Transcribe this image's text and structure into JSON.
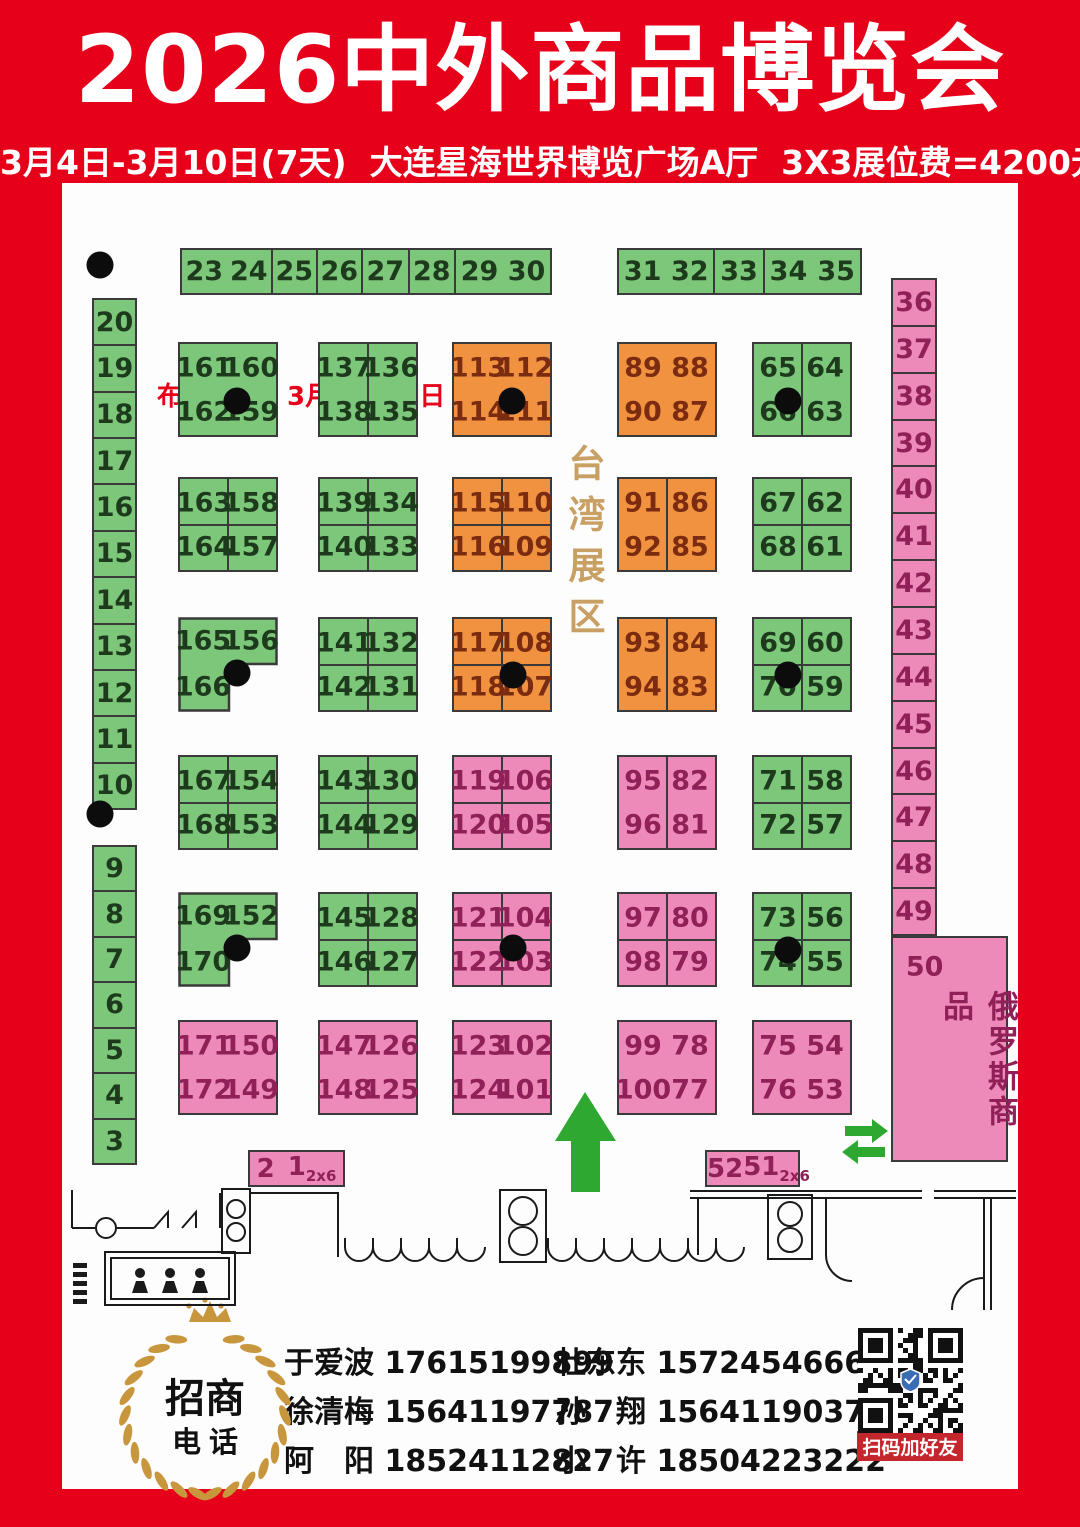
{
  "header": {
    "title": "2026中外商品博览会",
    "subtitle": "3月4日-3月10日(7天)  大连星海世界博览广场A厅  3X3展位费=4200元",
    "note": "布展日期：3月2日、3日"
  },
  "palette": {
    "red": "#e60019",
    "green": "#7dc77b",
    "orange": "#f0923f",
    "pink": "#ee8ab9",
    "border": "#3a3a3a",
    "green_text": "#1d3a1d",
    "orange_text": "#7a2b10",
    "pink_text": "#8f2058",
    "taiwan_text": "#c9a064",
    "arrow_green": "#2fa832",
    "dot": "#0c0c0c",
    "qr_label_bg": "#c4262d",
    "gold": "#c8963c"
  },
  "zones": {
    "taiwan_label": "台湾展区",
    "russia_label": "俄罗斯商品",
    "russia_booth": "50"
  },
  "strips": [
    {
      "x": 180,
      "y": 248,
      "w": 372,
      "h": 47,
      "color": "green",
      "cells": [
        {
          "w": 92,
          "labels": [
            "23",
            "24"
          ]
        },
        {
          "w": 45,
          "labels": [
            "25"
          ]
        },
        {
          "w": 46,
          "labels": [
            "26"
          ]
        },
        {
          "w": 47,
          "labels": [
            "27"
          ]
        },
        {
          "w": 47,
          "labels": [
            "28"
          ]
        },
        {
          "w": 95,
          "labels": [
            "29",
            "30"
          ]
        }
      ]
    },
    {
      "x": 617,
      "y": 248,
      "w": 245,
      "h": 47,
      "color": "green",
      "cells": [
        {
          "w": 98,
          "labels": [
            "31",
            "32"
          ]
        },
        {
          "w": 50,
          "labels": [
            "33"
          ]
        },
        {
          "w": 97,
          "labels": [
            "34",
            "35"
          ]
        }
      ]
    }
  ],
  "left_column": {
    "x": 92,
    "w": 45,
    "color": "green",
    "segments": [
      {
        "y": 298,
        "h": 512,
        "numbers": [
          "20",
          "19",
          "18",
          "17",
          "16",
          "15",
          "14",
          "13",
          "12",
          "11",
          "10"
        ]
      },
      {
        "y": 845,
        "h": 320,
        "numbers": [
          "9",
          "8",
          "7",
          "6",
          "5",
          "4",
          "3"
        ]
      }
    ]
  },
  "right_column": {
    "x": 891,
    "y": 278,
    "w": 46,
    "h": 658,
    "color": "pink",
    "numbers": [
      "36",
      "37",
      "38",
      "39",
      "40",
      "41",
      "42",
      "43",
      "44",
      "45",
      "46",
      "47",
      "48",
      "49"
    ]
  },
  "russia_block": {
    "x": 891,
    "y": 936,
    "w": 117,
    "h": 226,
    "color": "pink"
  },
  "blocks": [
    {
      "x": 178,
      "y": 342,
      "color": "green",
      "shape": "grid",
      "dividers": "none",
      "cells": [
        "161",
        "160",
        "162",
        "159"
      ],
      "dot": [
        59,
        63
      ]
    },
    {
      "x": 318,
      "y": 342,
      "color": "green",
      "shape": "grid",
      "dividers": "v",
      "cells": [
        "137",
        "136",
        "138",
        "135"
      ],
      "dot": null
    },
    {
      "x": 452,
      "y": 342,
      "color": "orange",
      "shape": "grid",
      "dividers": "none",
      "cells": [
        "113",
        "112",
        "114",
        "111"
      ],
      "dot": [
        60,
        63
      ]
    },
    {
      "x": 617,
      "y": 342,
      "color": "orange",
      "shape": "grid",
      "dividers": "none",
      "cells": [
        "89",
        "88",
        "90",
        "87"
      ],
      "dot": null
    },
    {
      "x": 752,
      "y": 342,
      "color": "green",
      "shape": "grid",
      "dividers": "v",
      "cells": [
        "65",
        "64",
        "66",
        "63"
      ],
      "dot": [
        35,
        63
      ]
    },
    {
      "x": 178,
      "y": 477,
      "color": "green",
      "shape": "grid",
      "dividers": "grid",
      "cells": [
        "163",
        "158",
        "164",
        "157"
      ],
      "dot": null
    },
    {
      "x": 318,
      "y": 477,
      "color": "green",
      "shape": "grid",
      "dividers": "grid",
      "cells": [
        "139",
        "134",
        "140",
        "133"
      ],
      "dot": null
    },
    {
      "x": 452,
      "y": 477,
      "color": "orange",
      "shape": "grid",
      "dividers": "grid",
      "cells": [
        "115",
        "110",
        "116",
        "109"
      ],
      "dot": null
    },
    {
      "x": 617,
      "y": 477,
      "color": "orange",
      "shape": "grid",
      "dividers": "v",
      "cells": [
        "91",
        "86",
        "92",
        "85"
      ],
      "dot": null
    },
    {
      "x": 752,
      "y": 477,
      "color": "green",
      "shape": "grid",
      "dividers": "grid",
      "cells": [
        "67",
        "62",
        "68",
        "61"
      ],
      "dot": null
    },
    {
      "x": 178,
      "y": 617,
      "color": "green",
      "shape": "L",
      "dividers": "none",
      "cells": [
        "165",
        "156",
        "166"
      ],
      "dot": [
        59,
        59
      ]
    },
    {
      "x": 318,
      "y": 617,
      "color": "green",
      "shape": "grid",
      "dividers": "grid",
      "cells": [
        "141",
        "132",
        "142",
        "131"
      ],
      "dot": null
    },
    {
      "x": 452,
      "y": 617,
      "color": "orange",
      "shape": "grid",
      "dividers": "grid",
      "cells": [
        "117",
        "108",
        "118",
        "107"
      ],
      "dot": [
        61,
        61
      ]
    },
    {
      "x": 617,
      "y": 617,
      "color": "orange",
      "shape": "grid",
      "dividers": "v",
      "cells": [
        "93",
        "84",
        "94",
        "83"
      ],
      "dot": null
    },
    {
      "x": 752,
      "y": 617,
      "color": "green",
      "shape": "grid",
      "dividers": "grid",
      "cells": [
        "69",
        "60",
        "70",
        "59"
      ],
      "dot": [
        35,
        61
      ]
    },
    {
      "x": 178,
      "y": 755,
      "color": "green",
      "shape": "grid",
      "dividers": "grid",
      "cells": [
        "167",
        "154",
        "168",
        "153"
      ],
      "dot": null
    },
    {
      "x": 318,
      "y": 755,
      "color": "green",
      "shape": "grid",
      "dividers": "grid",
      "cells": [
        "143",
        "130",
        "144",
        "129"
      ],
      "dot": null
    },
    {
      "x": 452,
      "y": 755,
      "color": "pink",
      "shape": "grid",
      "dividers": "grid",
      "cells": [
        "119",
        "106",
        "120",
        "105"
      ],
      "dot": null
    },
    {
      "x": 617,
      "y": 755,
      "color": "pink",
      "shape": "grid",
      "dividers": "v",
      "cells": [
        "95",
        "82",
        "96",
        "81"
      ],
      "dot": null
    },
    {
      "x": 752,
      "y": 755,
      "color": "green",
      "shape": "grid",
      "dividers": "grid",
      "cells": [
        "71",
        "58",
        "72",
        "57"
      ],
      "dot": null
    },
    {
      "x": 178,
      "y": 892,
      "color": "green",
      "shape": "L",
      "dividers": "none",
      "cells": [
        "169",
        "152",
        "170"
      ],
      "dot": [
        59,
        59
      ]
    },
    {
      "x": 318,
      "y": 892,
      "color": "green",
      "shape": "grid",
      "dividers": "grid",
      "cells": [
        "145",
        "128",
        "146",
        "127"
      ],
      "dot": null
    },
    {
      "x": 452,
      "y": 892,
      "color": "pink",
      "shape": "grid",
      "dividers": "grid",
      "cells": [
        "121",
        "104",
        "122",
        "103"
      ],
      "dot": [
        61,
        59
      ]
    },
    {
      "x": 617,
      "y": 892,
      "color": "pink",
      "shape": "grid",
      "dividers": "grid",
      "cells": [
        "97",
        "80",
        "98",
        "79"
      ],
      "dot": null
    },
    {
      "x": 752,
      "y": 892,
      "color": "green",
      "shape": "grid",
      "dividers": "grid",
      "cells": [
        "73",
        "56",
        "74",
        "55"
      ],
      "dot": [
        35,
        61
      ]
    },
    {
      "x": 178,
      "y": 1020,
      "color": "pink",
      "shape": "grid",
      "dividers": "none",
      "cells": [
        "171",
        "150",
        "172",
        "149"
      ],
      "dot": null
    },
    {
      "x": 318,
      "y": 1020,
      "color": "pink",
      "shape": "grid",
      "dividers": "none",
      "cells": [
        "147",
        "126",
        "148",
        "125"
      ],
      "dot": null
    },
    {
      "x": 452,
      "y": 1020,
      "color": "pink",
      "shape": "grid",
      "dividers": "none",
      "cells": [
        "123",
        "102",
        "124",
        "101"
      ],
      "dot": null
    },
    {
      "x": 617,
      "y": 1020,
      "color": "pink",
      "shape": "grid",
      "dividers": "none",
      "cells": [
        "99",
        "78",
        "100",
        "77"
      ],
      "dot": null
    },
    {
      "x": 752,
      "y": 1020,
      "color": "pink",
      "shape": "grid",
      "dividers": "none",
      "cells": [
        "75",
        "54",
        "76",
        "53"
      ],
      "dot": null
    }
  ],
  "small_blocks": [
    {
      "x": 248,
      "y": 1150,
      "w": 97,
      "h": 37,
      "labels": [
        "2",
        "1"
      ],
      "sub": "2x6"
    },
    {
      "x": 705,
      "y": 1150,
      "w": 95,
      "h": 37,
      "labels": [
        "52",
        "51"
      ],
      "sub": "2x6"
    }
  ],
  "free_dots": [
    {
      "x": 100,
      "y": 265
    },
    {
      "x": 100,
      "y": 814
    }
  ],
  "contacts": {
    "rows": [
      [
        "于爱波 17615199899",
        "杜东东 15724546666"
      ],
      [
        "徐清梅 15641197787",
        "孙　翔 15641190377"
      ],
      [
        "阿　阳 18524112827",
        "小　许 18504223222"
      ]
    ]
  },
  "badge": {
    "line1": "招商",
    "line2": "电话"
  },
  "qr": {
    "caption": "扫码加好友"
  }
}
